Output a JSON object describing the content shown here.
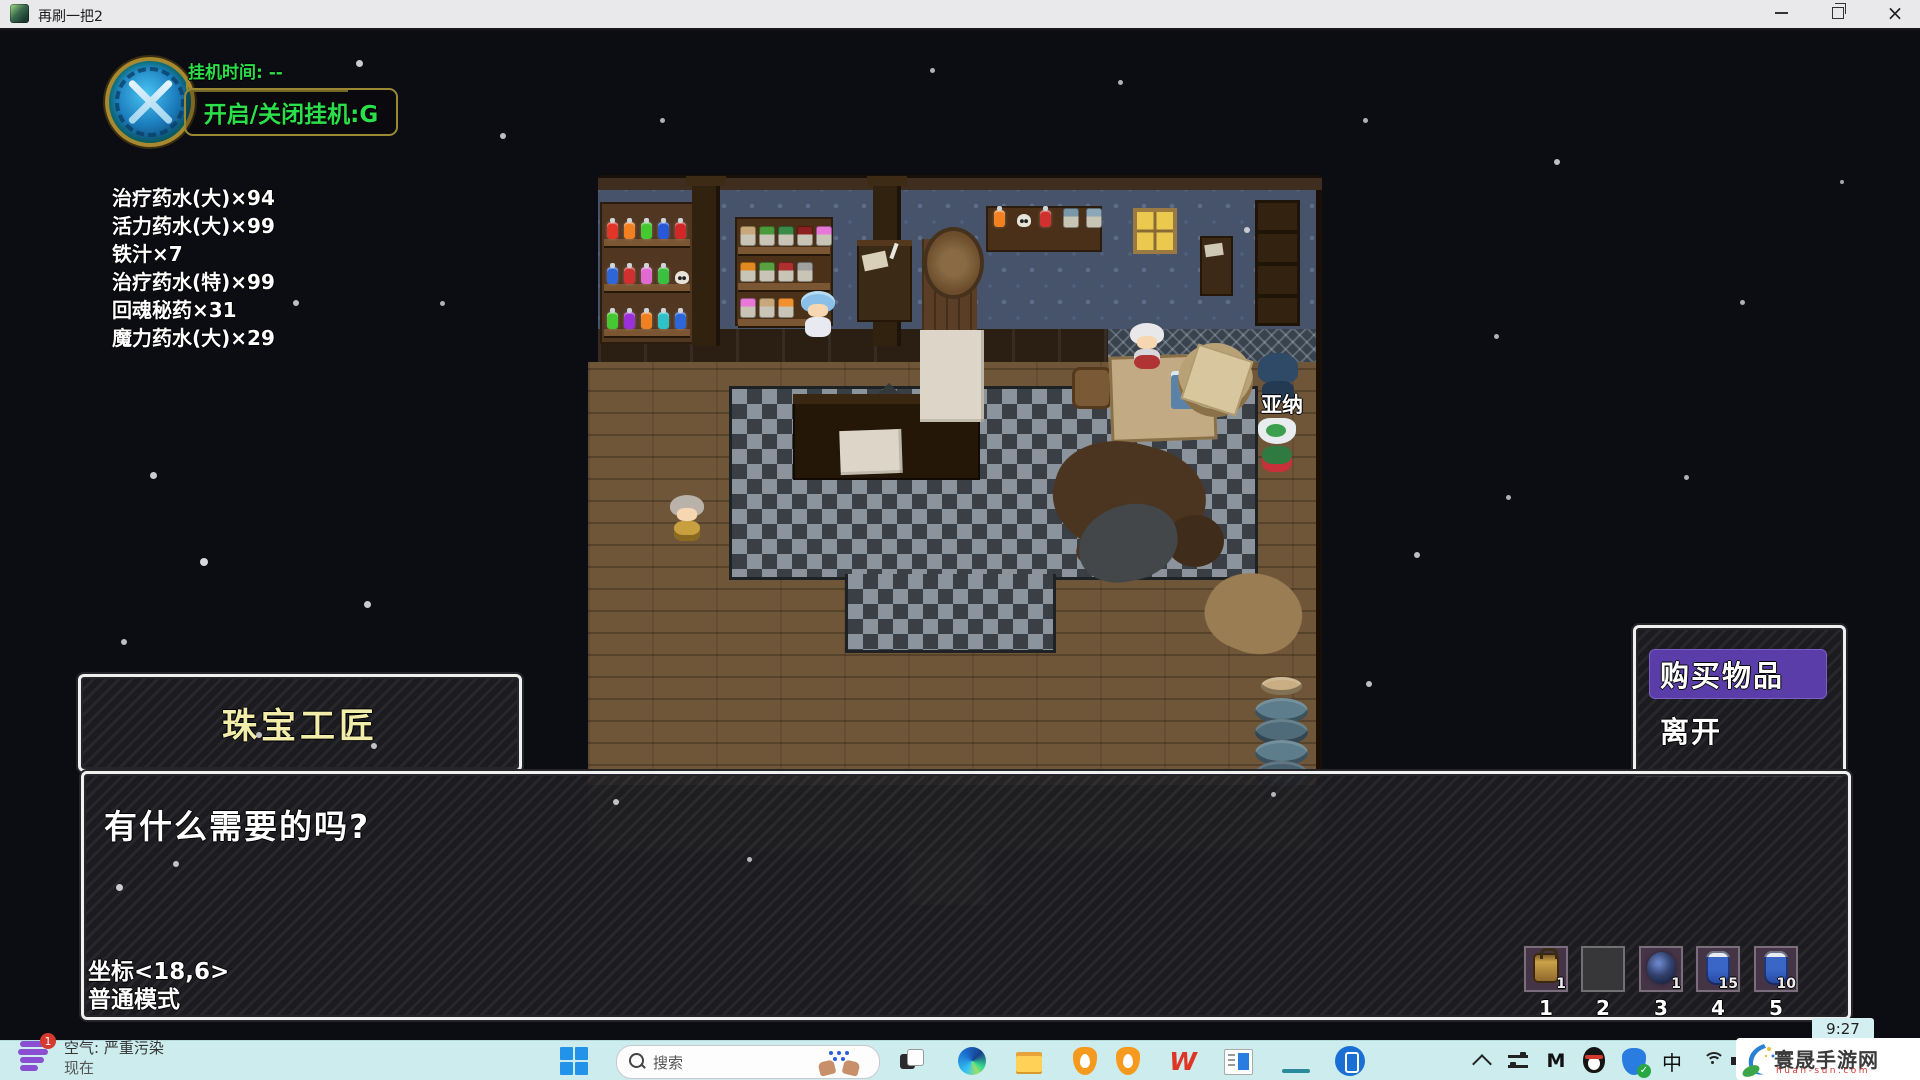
{
  "window": {
    "title": "再刷一把2"
  },
  "hud": {
    "afk_time_label": "挂机时间: --",
    "afk_toggle_label": "开启/关闭挂机:G",
    "inventory": [
      "治疗药水(大)×94",
      "活力药水(大)×99",
      "铁汁×7",
      "治疗药水(特)×99",
      "回魂秘药×31",
      "魔力药水(大)×29"
    ],
    "coordinates": "坐标<18,6>",
    "mode": "普通模式"
  },
  "scene": {
    "npc_name_label": "亚纳"
  },
  "dialog": {
    "speaker_name": "珠宝工匠",
    "message": "有什么需要的吗?"
  },
  "choice_menu": {
    "options": [
      {
        "label": "购买物品",
        "selected": true
      },
      {
        "label": "离开",
        "selected": false
      }
    ]
  },
  "hotbar": {
    "slots": [
      {
        "key": "1",
        "count": "1",
        "item": "lantern"
      },
      {
        "key": "2",
        "count": "",
        "item": "empty"
      },
      {
        "key": "3",
        "count": "1",
        "item": "dark-orb"
      },
      {
        "key": "4",
        "count": "15",
        "item": "blue-potion"
      },
      {
        "key": "5",
        "count": "10",
        "item": "blue-potion"
      }
    ]
  },
  "taskbar": {
    "weather": {
      "badge": "1",
      "headline": "空气: 严重污染",
      "subline": "现在"
    },
    "search": {
      "placeholder": "搜索"
    },
    "apps": [
      "task-view",
      "microsoft-edge",
      "file-explorer",
      "huorong-security",
      "huorong-security-2",
      "wps-office",
      "document-reader",
      "zaishua-game",
      "phone-link"
    ],
    "wps_letter": "W",
    "tray": {
      "m_label": "M",
      "ime_label": "中",
      "time": "9:27"
    },
    "watermark": {
      "site_name": "寰晟手游网",
      "site_url": "huan-sun.com"
    }
  },
  "colors": {
    "hud_green": "#2bdf4a",
    "speaker_yellow": "#f2edaa",
    "choice_highlight": "#5a3da8",
    "taskbar_bg": "#ccecee",
    "background": "#0c0c13"
  }
}
